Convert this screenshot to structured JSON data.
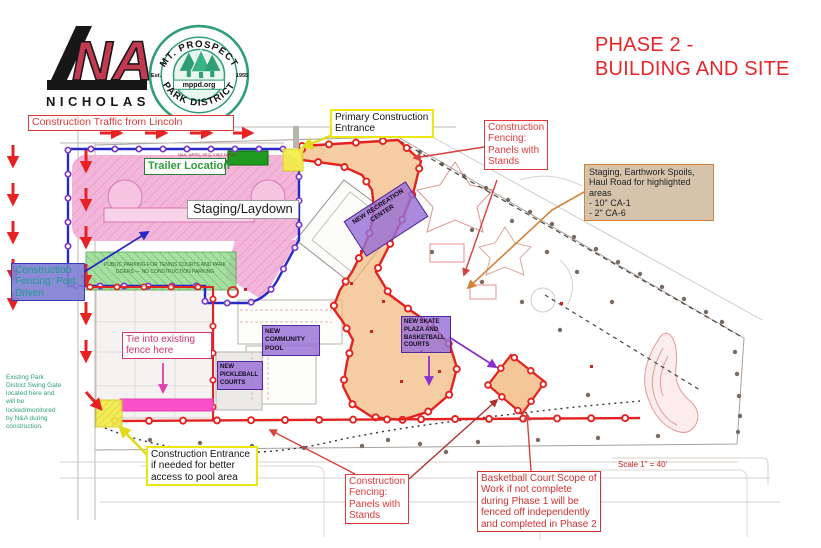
{
  "header": {
    "company": "NICHOLAS",
    "company_letters": "N I C H O L A S",
    "logo_mark": "NA",
    "seal": {
      "arc_top": "MT. PROSPECT",
      "arc_bottom": "PARK DISTRICT",
      "left": "Est.",
      "right": "1955",
      "banner": "mppd.org"
    },
    "title_line1": "PHASE 2 -",
    "title_line2": "BUILDING AND SITE"
  },
  "annotations": {
    "traffic": "Construction Traffic from Lincoln",
    "primary_entrance": "Primary Construction Entrance",
    "fencing_panels_top": "Construction Fencing: Panels with Stands",
    "staging_spoils_line1": "Staging, Earthwork Spoils, Haul Road for highlighted areas",
    "staging_spoils_line2": "- 10\" CA-1",
    "staging_spoils_line3": "- 2\" CA-6",
    "trailer_location": "Trailer Location",
    "staging_laydown": "Staging/Laydown",
    "fencing_post_driven": "Construction Fencing: Post Driven",
    "tie_fence": "Tie into existing fence here",
    "swing_gate_note": "Existing Park District Swing Gate located here and will be locked/monitored by N&A during construction.",
    "pool_entrance": "Construction Entrance if needed for better access to pool area",
    "fencing_panels_bottom": "Construction Fencing: Panels with Stands",
    "basketball_scope": "Basketball Court Scope of Work if not complete during Phase 1 will be fenced off independently and completed in Phase 2"
  },
  "map_labels": {
    "rec_center": "NEW RECREATION CENTER",
    "community_pool": "NEW COMMUNITY POOL",
    "pickleball": "NEW PICKLEBALL COURTS",
    "skate_plaza": "NEW SKATE PLAZA AND BASKETBALL COURTS",
    "public_parking": "PUBLIC PARKING FOR TENNIS COURTS AND PARK GOERS — NO CONSTRUCTION PARKING",
    "parking_strip_note": "N&A, MPPD, SEQ, VISIT PARKG",
    "scale": "Scale 1\" = 40'"
  },
  "colors": {
    "title_red": "#e8262a",
    "fence_red": "#e42320",
    "callout_red": "#e03a3a",
    "entrance_yellow": "#ece712",
    "staging_pink": "#f2aed6",
    "tie_strip_magenta": "#fb50c8",
    "highlight_orange": "#f3b87e",
    "parking_green": "#8fd98a",
    "trailer_green": "#1f9c1f",
    "facility_purple": "#9770d5",
    "post_driven_purple": "#8080d2",
    "fence_blue": "#2828c8",
    "gate_note_teal": "#2e9e7e",
    "staging_tan": "#d6c3ab",
    "staging_tan_border": "#d4823a"
  }
}
